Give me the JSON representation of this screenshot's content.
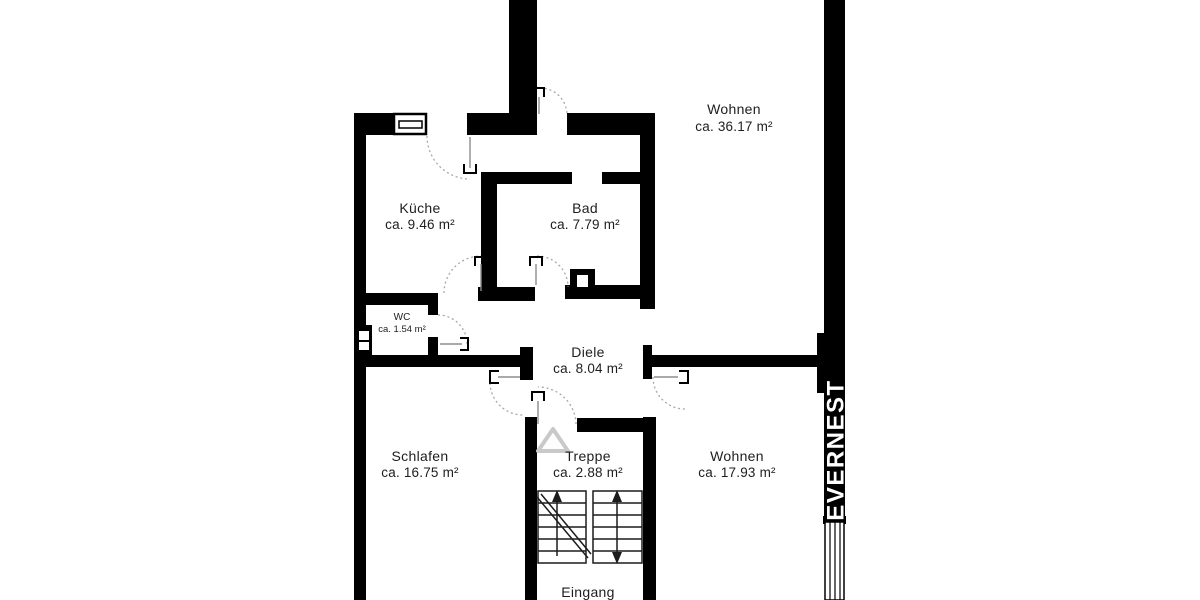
{
  "floorplan": {
    "rooms": [
      {
        "id": "wohnen-top",
        "name": "Wohnen",
        "area": "ca. 36.17 m²"
      },
      {
        "id": "kueche",
        "name": "Küche",
        "area": "ca. 9.46 m²"
      },
      {
        "id": "bad",
        "name": "Bad",
        "area": "ca. 7.79 m²"
      },
      {
        "id": "wc",
        "name": "WC",
        "area": "ca. 1.54 m²"
      },
      {
        "id": "diele",
        "name": "Diele",
        "area": "ca. 8.04 m²"
      },
      {
        "id": "schlafen",
        "name": "Schlafen",
        "area": "ca. 16.75 m²"
      },
      {
        "id": "treppe",
        "name": "Treppe",
        "area": "ca. 2.88 m²"
      },
      {
        "id": "wohnen-bottom",
        "name": "Wohnen",
        "area": "ca. 17.93 m²"
      },
      {
        "id": "eingang",
        "name": "Eingang",
        "area": ""
      }
    ],
    "branding": {
      "logo": "EVERNEST"
    },
    "colors": {
      "background": "#ffffff",
      "wall": "#000000",
      "text": "#1e1e1e",
      "door_arc": "#a8a8a8",
      "stair_detail": "#1c1c1c",
      "direction_triangle": "#c9c9c9",
      "logo_background": "#000000",
      "logo_text": "#ffffff"
    }
  }
}
